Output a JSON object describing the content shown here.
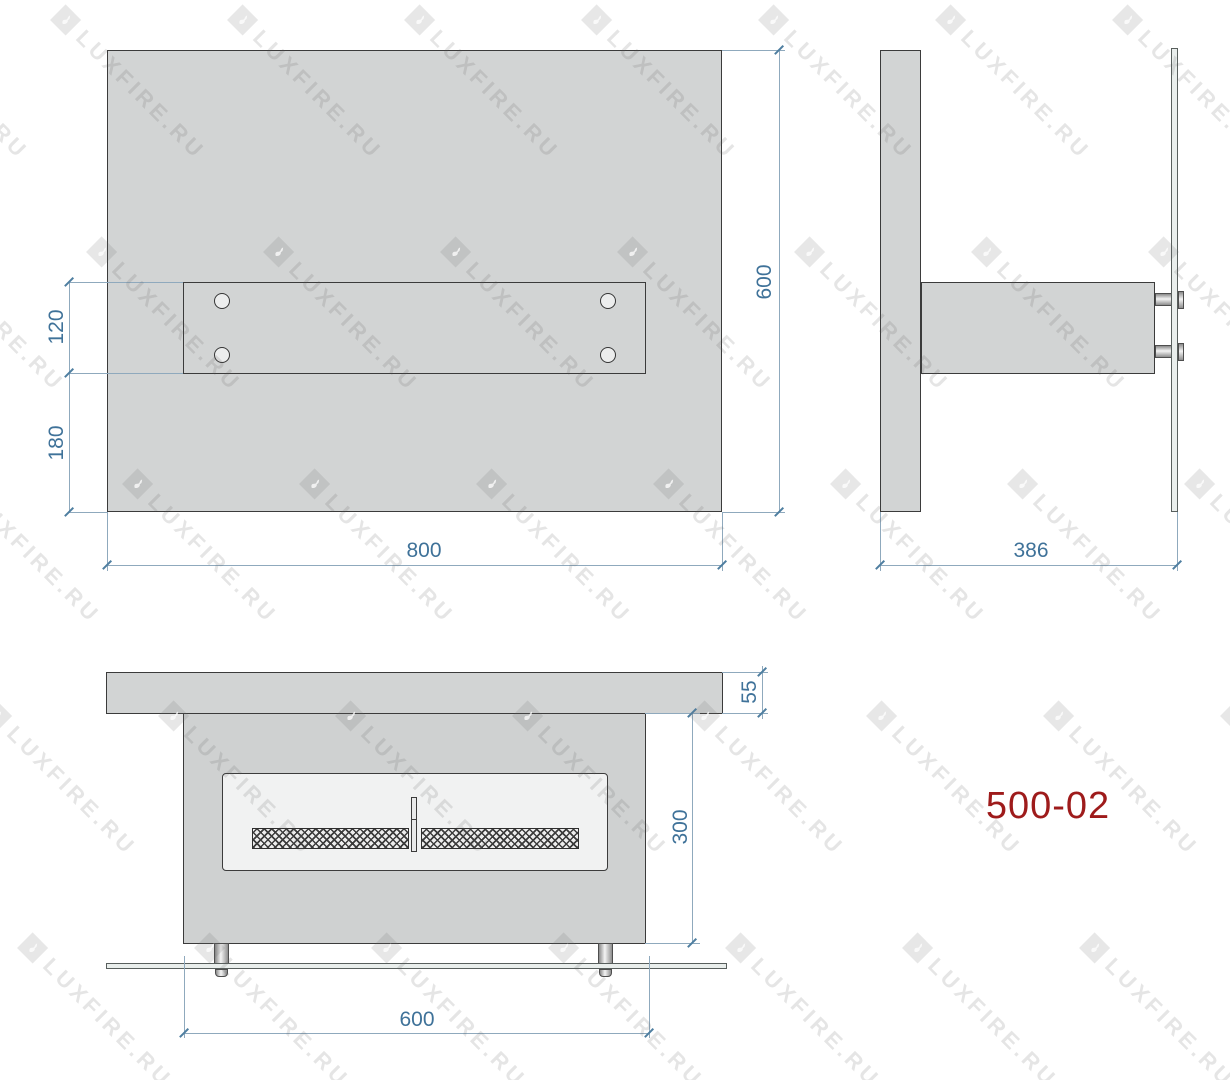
{
  "watermark": {
    "text": "LUXFIRE.RU"
  },
  "model_label": "500-02",
  "colors": {
    "panel_fill": "#d2d4d4",
    "outline": "#3b3b3b",
    "dimension_line": "#8fa9bd",
    "dimension_text": "#3f7299",
    "model_text": "#9e1b1b",
    "watermark_gray": "#e8e8e8"
  },
  "front_view": {
    "panel_width_label": "800",
    "panel_height_label": "600",
    "bracket_height_label": "120",
    "bracket_offset_label": "180"
  },
  "side_view": {
    "depth_label": "386"
  },
  "bottom_view": {
    "top_thickness_label": "55",
    "body_height_label": "300",
    "body_width_label": "600"
  }
}
